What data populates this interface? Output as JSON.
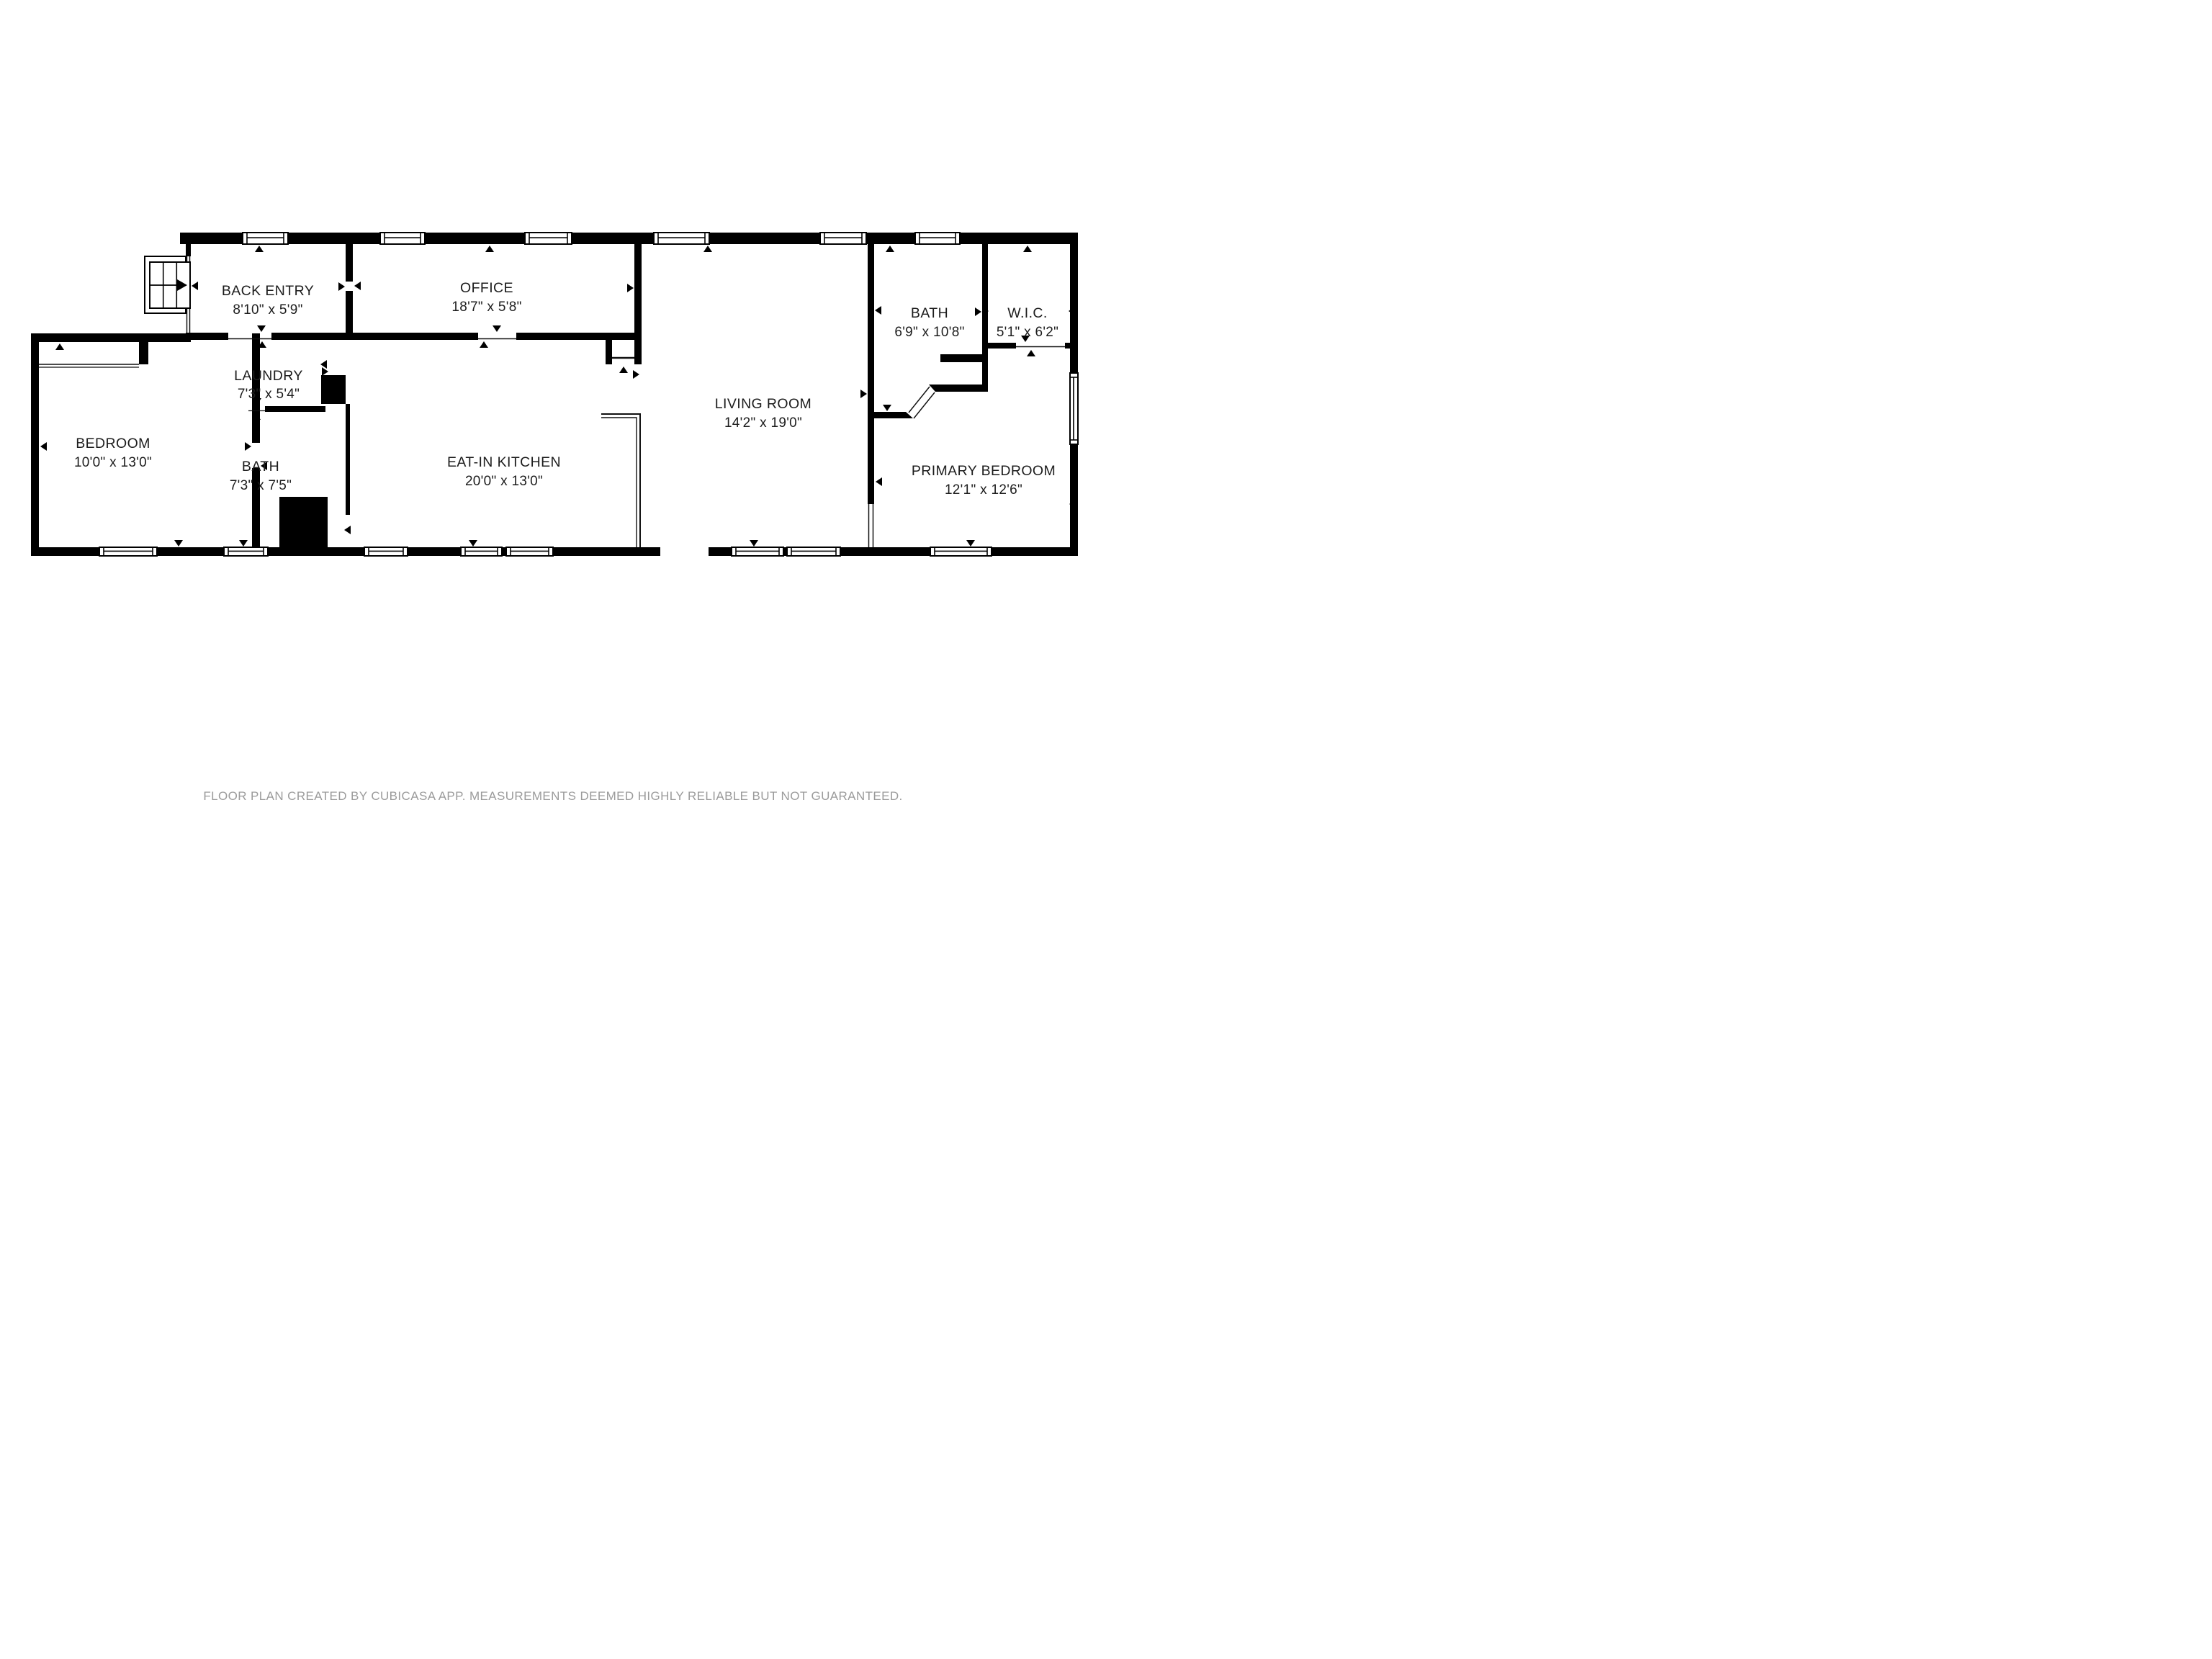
{
  "meta": {
    "footer": "FLOOR PLAN CREATED BY CUBICASA APP. MEASUREMENTS DEEMED HIGHLY RELIABLE BUT NOT GUARANTEED."
  },
  "rooms": [
    {
      "id": "back-entry",
      "name": "BACK ENTRY",
      "dims": "8'10\" x 5'9\""
    },
    {
      "id": "office",
      "name": "OFFICE",
      "dims": "18'7\" x 5'8\""
    },
    {
      "id": "living-room",
      "name": "LIVING ROOM",
      "dims": "14'2\" x 19'0\""
    },
    {
      "id": "bath-upper",
      "name": "BATH",
      "dims": "6'9\" x 10'8\""
    },
    {
      "id": "wic",
      "name": "W.I.C.",
      "dims": "5'1\" x 6'2\""
    },
    {
      "id": "bedroom",
      "name": "BEDROOM",
      "dims": "10'0\" x 13'0\""
    },
    {
      "id": "laundry",
      "name": "LAUNDRY",
      "dims": "7'3\" x 5'4\""
    },
    {
      "id": "bath-lower",
      "name": "BATH",
      "dims": "7'3\" x 7'5\""
    },
    {
      "id": "eat-in-kitchen",
      "name": "EAT-IN KITCHEN",
      "dims": "20'0\" x 13'0\""
    },
    {
      "id": "primary-bedroom",
      "name": "PRIMARY BEDROOM",
      "dims": "12'1\" x 12'6\""
    }
  ]
}
